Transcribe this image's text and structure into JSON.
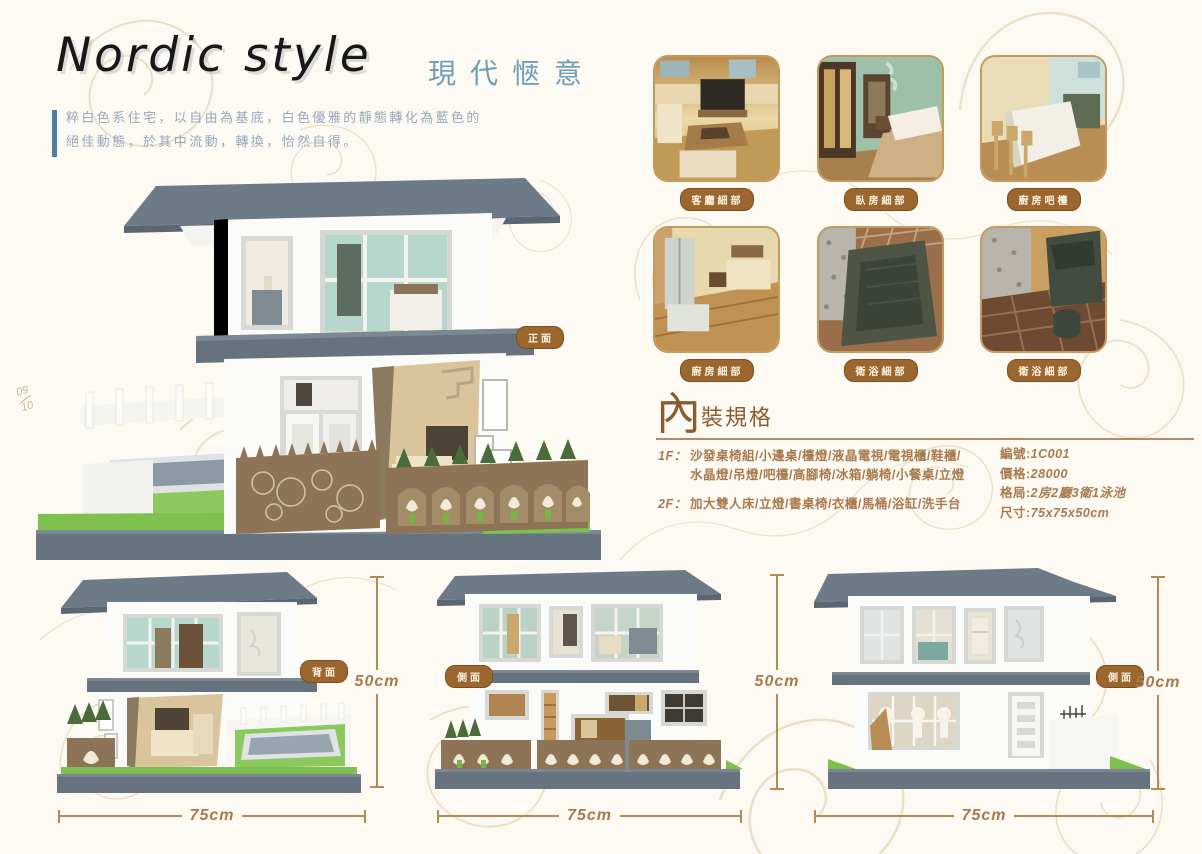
{
  "page": {
    "title": "Nordic style",
    "subtitle": "現代愜意",
    "description_line1": "粹白色系住宅，以自由為基底，白色優雅的靜態轉化為藍色的",
    "description_line2": "絕佳動態，於其中流動，轉換，怡然自得。",
    "page_number_top": "09",
    "page_number_bottom": "10"
  },
  "colors": {
    "background": "#fdfaf3",
    "accent_brown": "#9b672e",
    "accent_blue": "#6f9fb6",
    "text_brown": "#a97a4d",
    "roof_gray": "#6d7b88",
    "grass_green": "#7dc04d",
    "dimension_line": "#b28a52"
  },
  "main_view": {
    "label": "正面"
  },
  "detail_photos": [
    {
      "label": "客廳細部"
    },
    {
      "label": "臥房細部"
    },
    {
      "label": "廚房吧檯"
    },
    {
      "label": "廚房細部"
    },
    {
      "label": "衛浴細部"
    },
    {
      "label": "衛浴細部"
    }
  ],
  "specs": {
    "heading_char": "內",
    "heading_rest": "裝規格",
    "floor1_label": "1F：",
    "floor1_line1": "沙發桌椅組/小邊桌/檯燈/液晶電視/電視櫃/鞋櫃/",
    "floor1_line2": "水晶燈/吊燈/吧檯/高腳椅/冰箱/躺椅/小餐桌/立燈",
    "floor2_label": "2F：",
    "floor2_items": "加大雙人床/立燈/書桌椅/衣櫃/馬桶/浴缸/洗手台",
    "fields": [
      {
        "label": "編號:",
        "value": "1C001"
      },
      {
        "label": "價格:",
        "value": "28000"
      },
      {
        "label": "格局:",
        "value": "2房2廳3衛1泳池"
      },
      {
        "label": "尺寸:",
        "value": "75x75x50cm"
      }
    ]
  },
  "elevations": [
    {
      "label": "背面",
      "height": "50cm",
      "width": "75cm"
    },
    {
      "label": "側面",
      "height": "50cm",
      "width": "75cm"
    },
    {
      "label": "側面",
      "height": "50cm",
      "width": "75cm"
    }
  ]
}
